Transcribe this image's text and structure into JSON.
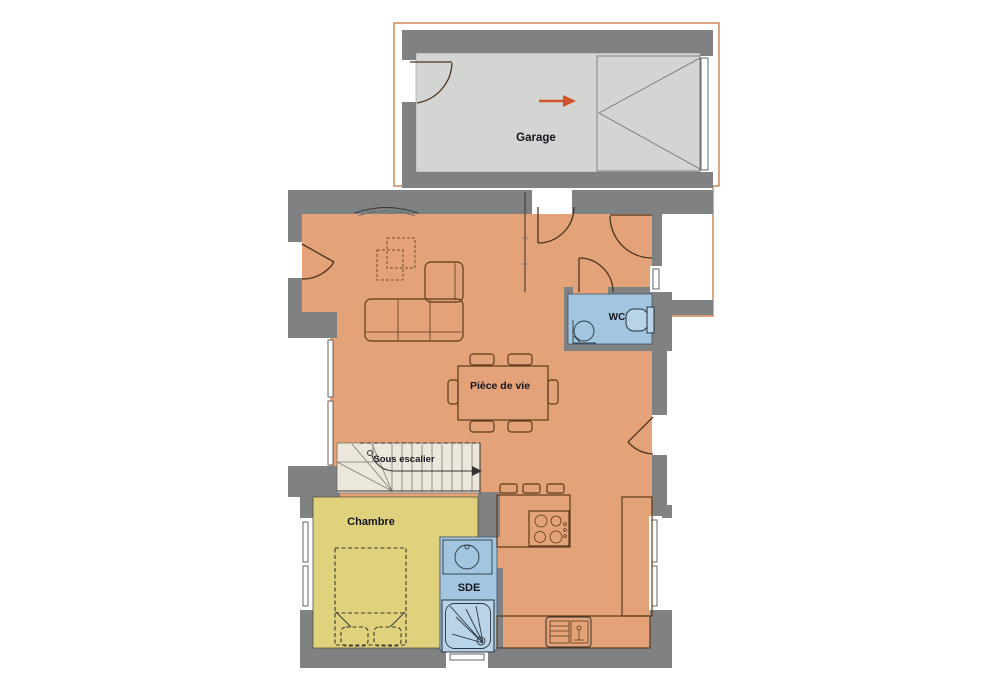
{
  "plan": {
    "title": "floor-plan",
    "rooms": {
      "garage": {
        "label": "Garage"
      },
      "living": {
        "label": "Pièce de vie"
      },
      "wc": {
        "label": "WC"
      },
      "under_stairs": {
        "label": "Sous escalier"
      },
      "bedroom": {
        "label": "Chambre"
      },
      "shower_room": {
        "label": "SDE"
      }
    },
    "colors": {
      "wall": "#7f8182",
      "garage_floor": "#d3d5d2",
      "living_floor": "#e3a277",
      "bedroom_floor": "#e0d17c",
      "wet_floor": "#a3c6e0",
      "stairs_floor": "#ebe7da",
      "outline": "#cd7f50",
      "arrow": "#d0552e",
      "furniture": "#5d3a1a",
      "fixture_fill": "#b9d4e8",
      "label_text": "#15151f"
    }
  }
}
